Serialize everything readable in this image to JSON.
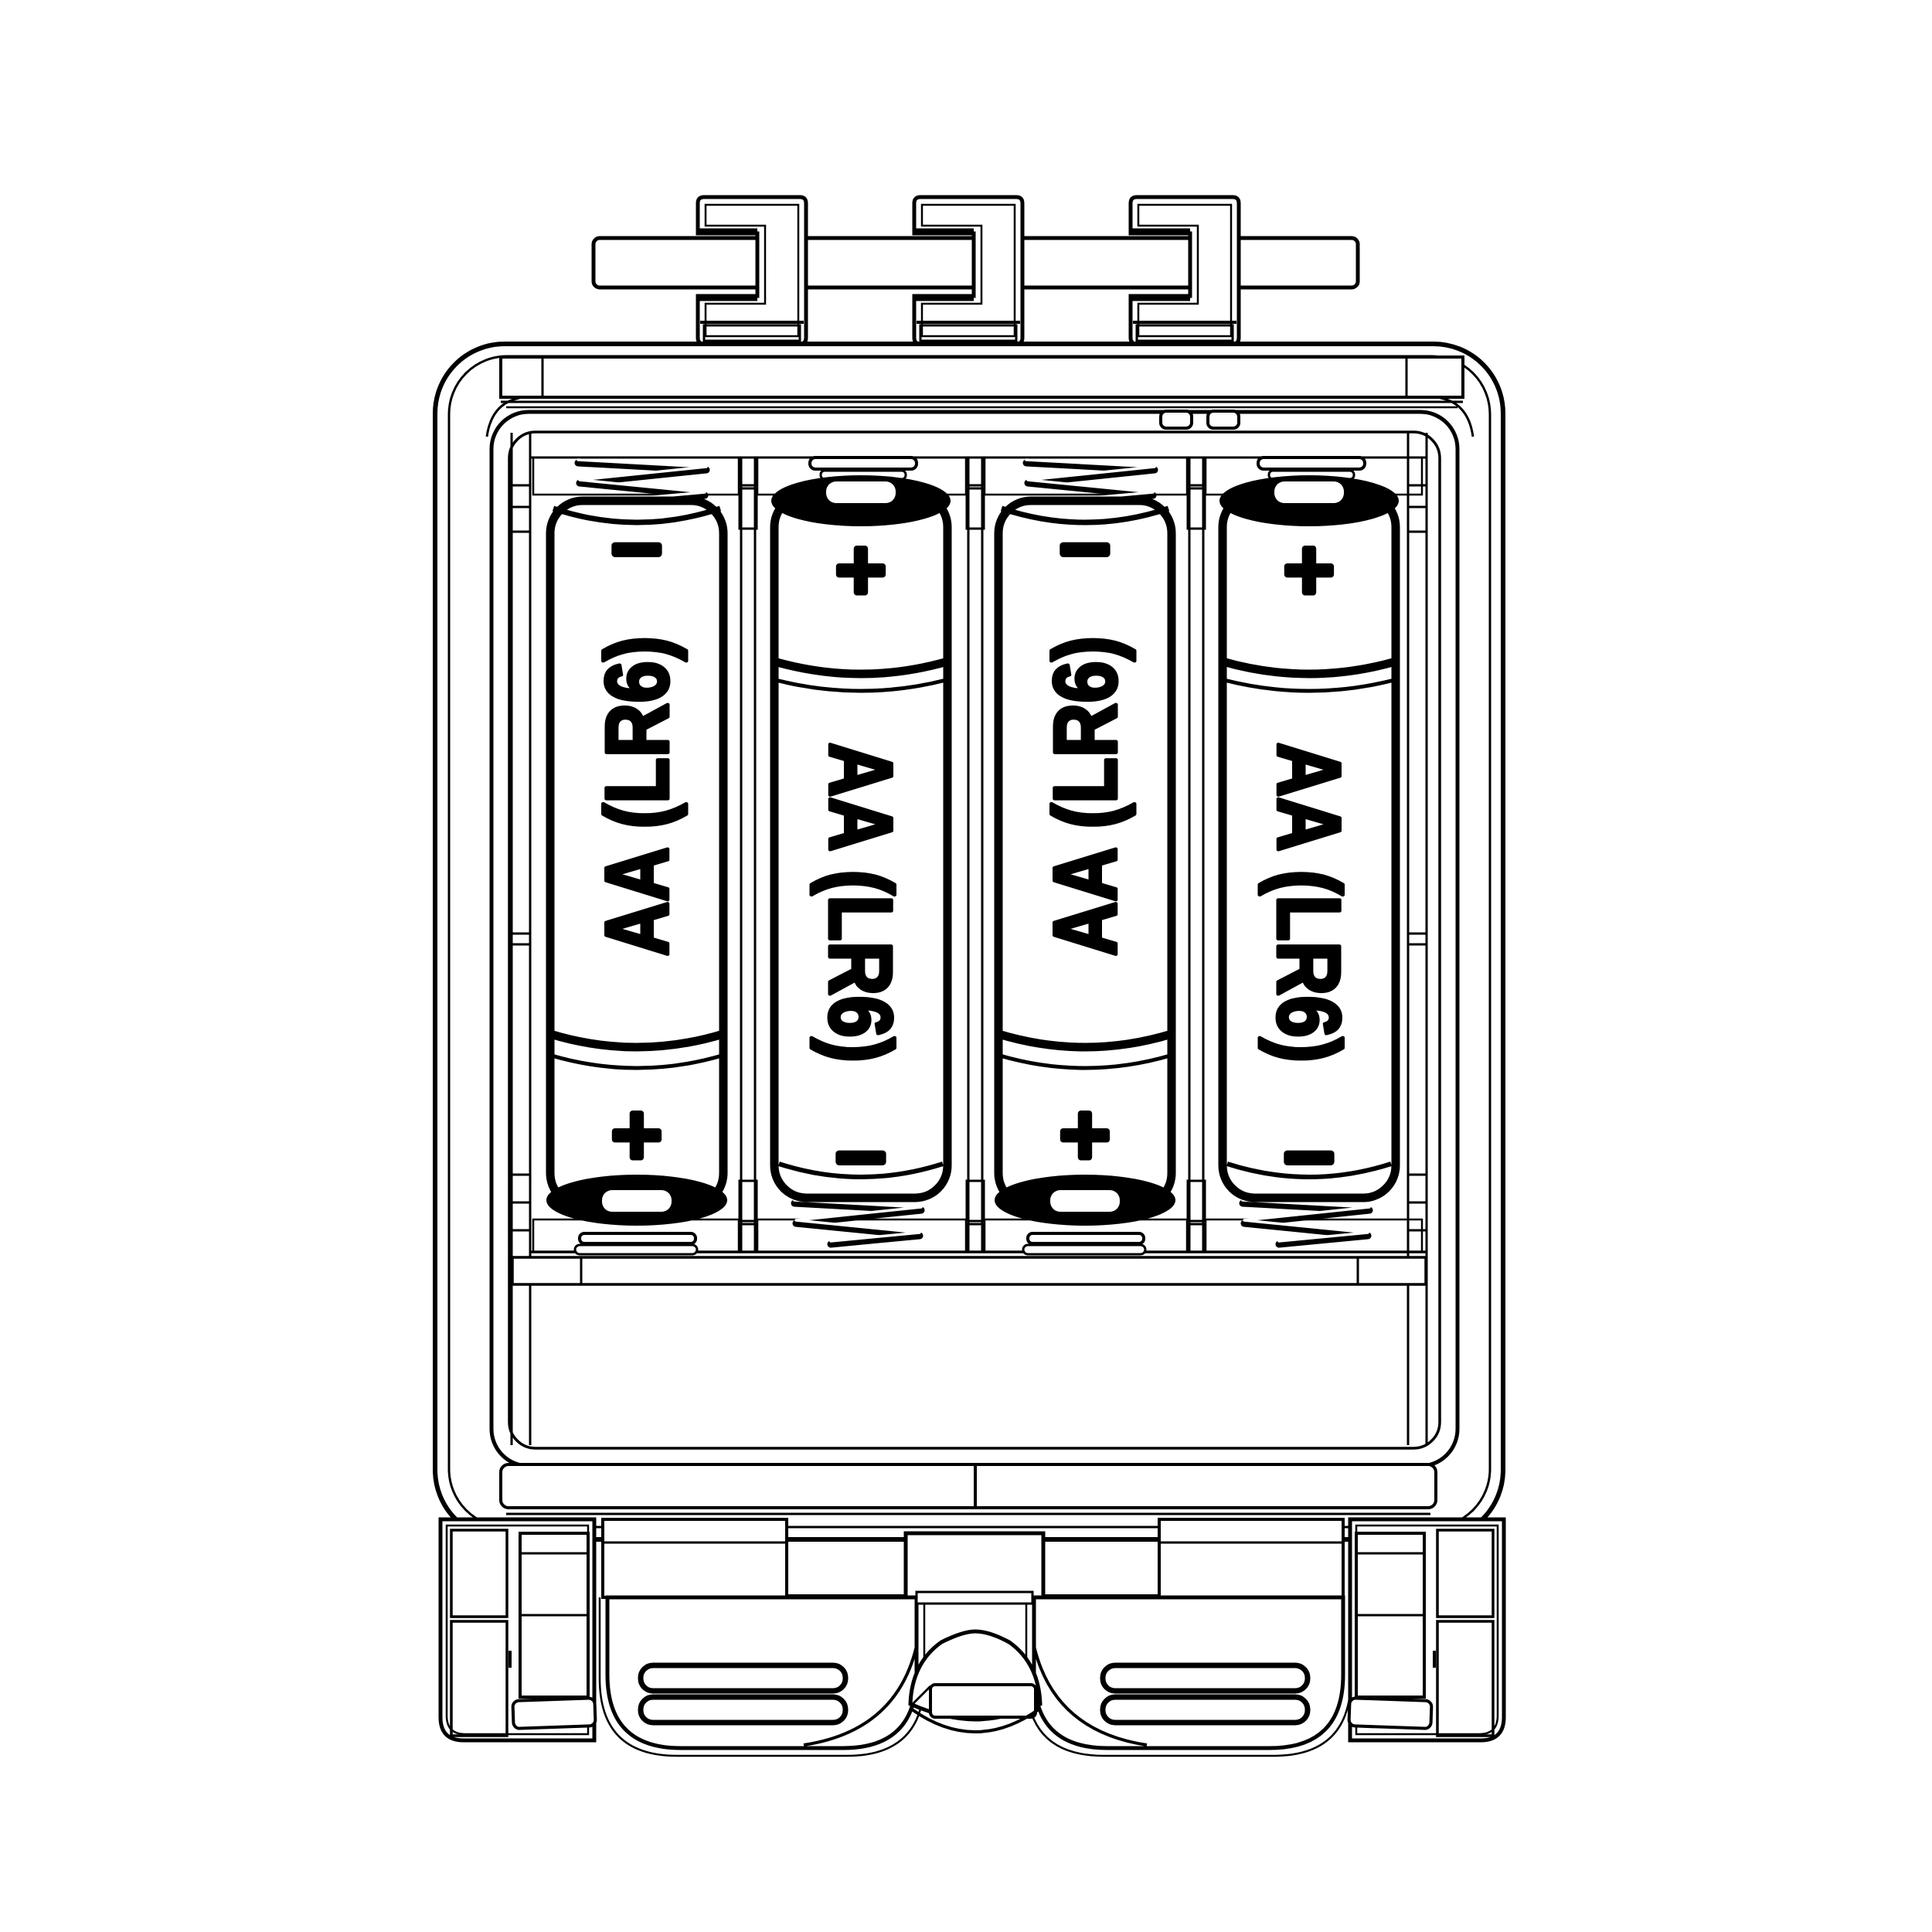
{
  "diagram": {
    "type": "battery-compartment-technical-drawing",
    "background_color": "#ffffff",
    "line_color": "#000000",
    "battery_count": 4,
    "batteries": [
      {
        "slot": 1,
        "label": "AA (LR6)",
        "top_terminal": "−",
        "bottom_terminal": "+",
        "orientation": "negative-up",
        "top_contact": "spring",
        "bottom_contact": "plate"
      },
      {
        "slot": 2,
        "label": "AA (LR6)",
        "top_terminal": "+",
        "bottom_terminal": "−",
        "orientation": "positive-up",
        "top_contact": "plate",
        "bottom_contact": "spring"
      },
      {
        "slot": 3,
        "label": "AA (LR6)",
        "top_terminal": "−",
        "bottom_terminal": "+",
        "orientation": "negative-up",
        "top_contact": "spring",
        "bottom_contact": "plate"
      },
      {
        "slot": 4,
        "label": "AA (LR6)",
        "top_terminal": "+",
        "bottom_terminal": "−",
        "orientation": "positive-up",
        "top_contact": "plate",
        "bottom_contact": "spring"
      }
    ]
  }
}
